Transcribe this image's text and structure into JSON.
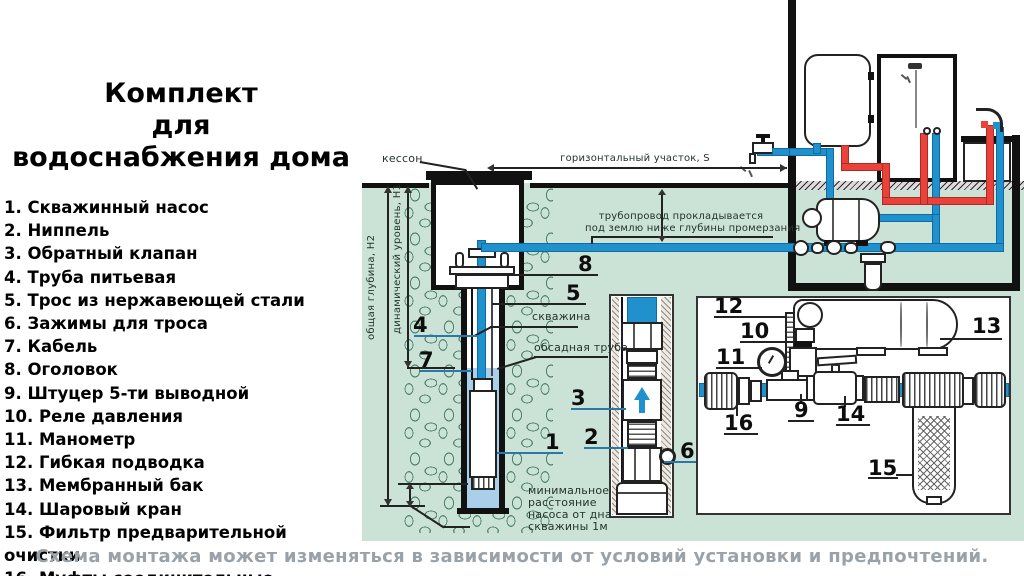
{
  "title": {
    "lines": [
      "Комплект",
      "для",
      "водоснабжения дома"
    ]
  },
  "legend": {
    "items": [
      "1. Скважинный насос",
      "2. Ниппель",
      "3. Обратный клапан",
      "4. Труба питьевая",
      "5. Трос из нержавеющей стали",
      "6. Зажимы для троса",
      "7. Кабель",
      "8. Оголовок",
      "9. Штуцер 5-ти выводной",
      "10. Реле давления",
      "11. Манометр",
      "12. Гибкая подводка",
      "13. Мембранный бак",
      "14. Шаровый кран",
      "15. Фильтр предварительной очистки",
      "16. Муфты соединительные"
    ]
  },
  "caption": "Схема монтажа может изменяться в зависимости от условий установки и предпочтений.",
  "diagram": {
    "labels": {
      "caisson": "кессон",
      "horizontal_section": "горизонтальный участок,  S",
      "frost_line1": "трубопровод прокладывается",
      "frost_line2": "под землю ниже глубины промерзания",
      "total_depth": "общая глубина, Н2",
      "dynamic_level": "динамический уровень, Н1",
      "borehole": "скважина",
      "casing_pipe": "обсадная труба",
      "min_dist_line1": "минимальное",
      "min_dist_line2": "расстояние",
      "min_dist_line3": "насоса от дна",
      "min_dist_line4": "скважины 1м"
    },
    "callouts": {
      "1": "1",
      "2": "2",
      "3": "3",
      "4": "4",
      "5": "5",
      "6": "6",
      "7": "7",
      "8": "8",
      "9": "9",
      "10": "10",
      "11": "11",
      "12": "12",
      "13": "13",
      "14": "14",
      "15": "15",
      "16": "16"
    }
  },
  "colors": {
    "ground": "#cbe3d6",
    "pipe_cold": "#2191ce",
    "pipe_hot": "#e8423a",
    "water": "#a9cfe9",
    "stone_outline": "#4d7e68",
    "caption_gray": "#9aa2a9"
  }
}
